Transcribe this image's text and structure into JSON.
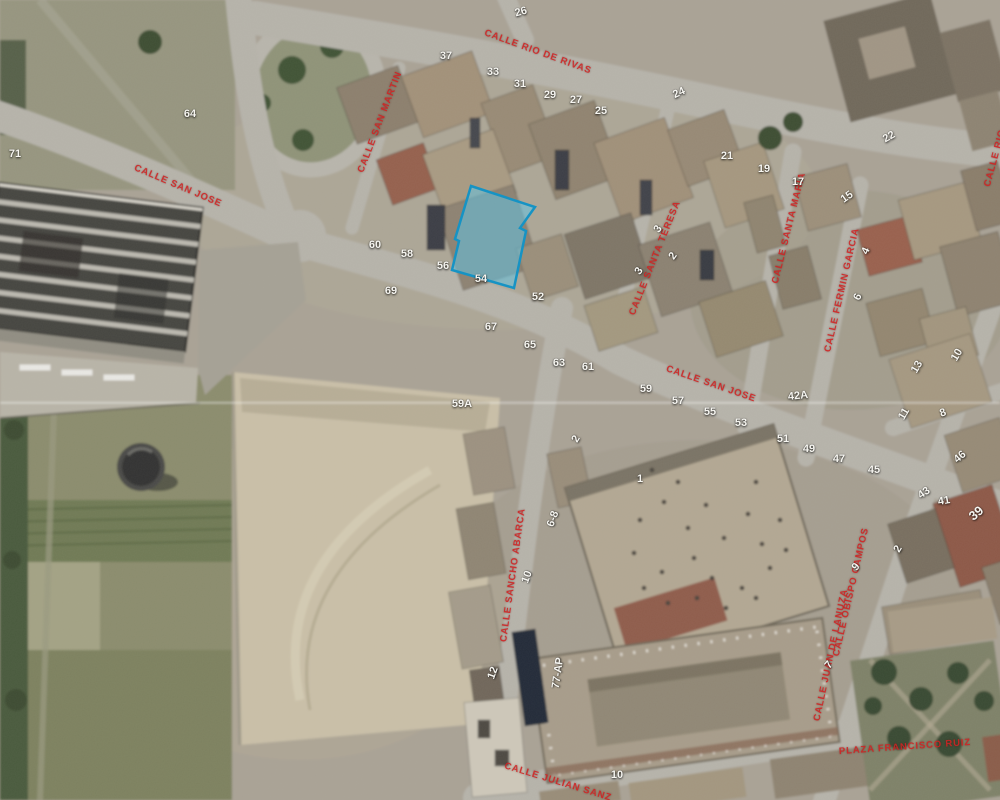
{
  "map": {
    "view_type": "aerial-cadastral",
    "label_color": "#cf2323",
    "number_color": "#f7f6f1",
    "selected_parcel": {
      "points": "471,186 535,207 520,228 526,231 514,288 452,270 459,241 455,239",
      "fill": "#5ec8eb",
      "fill_opacity": 0.5,
      "stroke": "#1693c4",
      "stroke_width": 2.5
    },
    "street_labels": [
      {
        "text": "CALLE RIO DE RIVAS",
        "x": 538,
        "y": 52,
        "r": 20
      },
      {
        "text": "CALLE SAN JOSE",
        "x": 178,
        "y": 186,
        "r": 23
      },
      {
        "text": "CALLE SAN MARTIN",
        "x": 380,
        "y": 122,
        "r": -69
      },
      {
        "text": "CALLE SANTA TERESA",
        "x": 655,
        "y": 258,
        "r": -68
      },
      {
        "text": "CALLE SANTA MARIA",
        "x": 789,
        "y": 228,
        "r": -76
      },
      {
        "text": "CALLE FERMIN GARCIA",
        "x": 842,
        "y": 290,
        "r": -77
      },
      {
        "text": "CALLE SAN JOSE",
        "x": 711,
        "y": 384,
        "r": 19
      },
      {
        "text": "CALLE SANCHO ABARCA",
        "x": 513,
        "y": 575,
        "r": -82
      },
      {
        "text": "CALLE OBISPO CAMPOS",
        "x": 851,
        "y": 592,
        "r": -77
      },
      {
        "text": "CALLE JUAN DE LANUZA",
        "x": 831,
        "y": 655,
        "r": -78
      },
      {
        "text": "PLAZA FRANCISCO RUIZ",
        "x": 905,
        "y": 747,
        "r": -4
      },
      {
        "text": "CALLE JULIAN SANZ",
        "x": 558,
        "y": 782,
        "r": 17
      },
      {
        "text": "CALLE RIO",
        "x": 995,
        "y": 158,
        "r": -75
      }
    ],
    "house_numbers": [
      {
        "text": "26",
        "x": 521,
        "y": 12,
        "r": -15
      },
      {
        "text": "37",
        "x": 446,
        "y": 56,
        "r": 0
      },
      {
        "text": "33",
        "x": 493,
        "y": 72,
        "r": 0
      },
      {
        "text": "31",
        "x": 520,
        "y": 84,
        "r": 0
      },
      {
        "text": "29",
        "x": 550,
        "y": 95,
        "r": 0
      },
      {
        "text": "27",
        "x": 576,
        "y": 100,
        "r": 0
      },
      {
        "text": "25",
        "x": 601,
        "y": 111,
        "r": 0
      },
      {
        "text": "24",
        "x": 679,
        "y": 93,
        "r": -25
      },
      {
        "text": "64",
        "x": 190,
        "y": 114,
        "r": 0
      },
      {
        "text": "71",
        "x": 15,
        "y": 154,
        "r": 0
      },
      {
        "text": "22",
        "x": 889,
        "y": 137,
        "r": -30
      },
      {
        "text": "21",
        "x": 727,
        "y": 156,
        "r": 0
      },
      {
        "text": "19",
        "x": 764,
        "y": 169,
        "r": 0
      },
      {
        "text": "17",
        "x": 798,
        "y": 182,
        "r": 0
      },
      {
        "text": "15",
        "x": 847,
        "y": 197,
        "r": -35
      },
      {
        "text": "4",
        "x": 866,
        "y": 251,
        "r": -65
      },
      {
        "text": "6",
        "x": 858,
        "y": 297,
        "r": -65
      },
      {
        "text": "60",
        "x": 375,
        "y": 245,
        "r": 0
      },
      {
        "text": "58",
        "x": 407,
        "y": 254,
        "r": 0
      },
      {
        "text": "56",
        "x": 443,
        "y": 266,
        "r": 0
      },
      {
        "text": "54",
        "x": 481,
        "y": 279,
        "r": 0
      },
      {
        "text": "52",
        "x": 538,
        "y": 297,
        "r": 0
      },
      {
        "text": "69",
        "x": 391,
        "y": 291,
        "r": 0
      },
      {
        "text": "67",
        "x": 491,
        "y": 327,
        "r": 0
      },
      {
        "text": "65",
        "x": 530,
        "y": 345,
        "r": 0
      },
      {
        "text": "63",
        "x": 559,
        "y": 363,
        "r": 0
      },
      {
        "text": "61",
        "x": 588,
        "y": 367,
        "r": 0
      },
      {
        "text": "59A",
        "x": 462,
        "y": 404,
        "r": 0
      },
      {
        "text": "3",
        "x": 658,
        "y": 229,
        "r": -55
      },
      {
        "text": "2",
        "x": 673,
        "y": 256,
        "r": -55
      },
      {
        "text": "3",
        "x": 639,
        "y": 271,
        "r": -55
      },
      {
        "text": "59",
        "x": 646,
        "y": 389,
        "r": 0
      },
      {
        "text": "57",
        "x": 678,
        "y": 401,
        "r": 0
      },
      {
        "text": "55",
        "x": 710,
        "y": 412,
        "r": 0
      },
      {
        "text": "53",
        "x": 741,
        "y": 423,
        "r": 0
      },
      {
        "text": "42A",
        "x": 798,
        "y": 396,
        "r": -6
      },
      {
        "text": "51",
        "x": 783,
        "y": 439,
        "r": 0
      },
      {
        "text": "49",
        "x": 809,
        "y": 449,
        "r": 0
      },
      {
        "text": "47",
        "x": 839,
        "y": 459,
        "r": 0
      },
      {
        "text": "45",
        "x": 874,
        "y": 470,
        "r": 0
      },
      {
        "text": "46",
        "x": 960,
        "y": 457,
        "r": -40
      },
      {
        "text": "43",
        "x": 924,
        "y": 493,
        "r": -35
      },
      {
        "text": "41",
        "x": 944,
        "y": 501,
        "r": -10
      },
      {
        "text": "39",
        "x": 976,
        "y": 513,
        "r": -40,
        "s": 13
      },
      {
        "text": "13",
        "x": 917,
        "y": 367,
        "r": -60
      },
      {
        "text": "10",
        "x": 957,
        "y": 355,
        "r": -60
      },
      {
        "text": "11",
        "x": 904,
        "y": 414,
        "r": -60
      },
      {
        "text": "8",
        "x": 943,
        "y": 413,
        "r": -20
      },
      {
        "text": "2",
        "x": 898,
        "y": 549,
        "r": -60
      },
      {
        "text": "1",
        "x": 640,
        "y": 479,
        "r": 0
      },
      {
        "text": "2",
        "x": 576,
        "y": 439,
        "r": -60
      },
      {
        "text": "6-8",
        "x": 553,
        "y": 519,
        "r": -70
      },
      {
        "text": "10",
        "x": 527,
        "y": 577,
        "r": -70
      },
      {
        "text": "12",
        "x": 493,
        "y": 673,
        "r": -70
      },
      {
        "text": "77-AP",
        "x": 558,
        "y": 673,
        "r": -82
      },
      {
        "text": "10",
        "x": 617,
        "y": 775,
        "r": 0
      },
      {
        "text": "9",
        "x": 856,
        "y": 567,
        "r": -50
      },
      {
        "text": "7",
        "x": 829,
        "y": 665,
        "r": -50
      }
    ]
  }
}
